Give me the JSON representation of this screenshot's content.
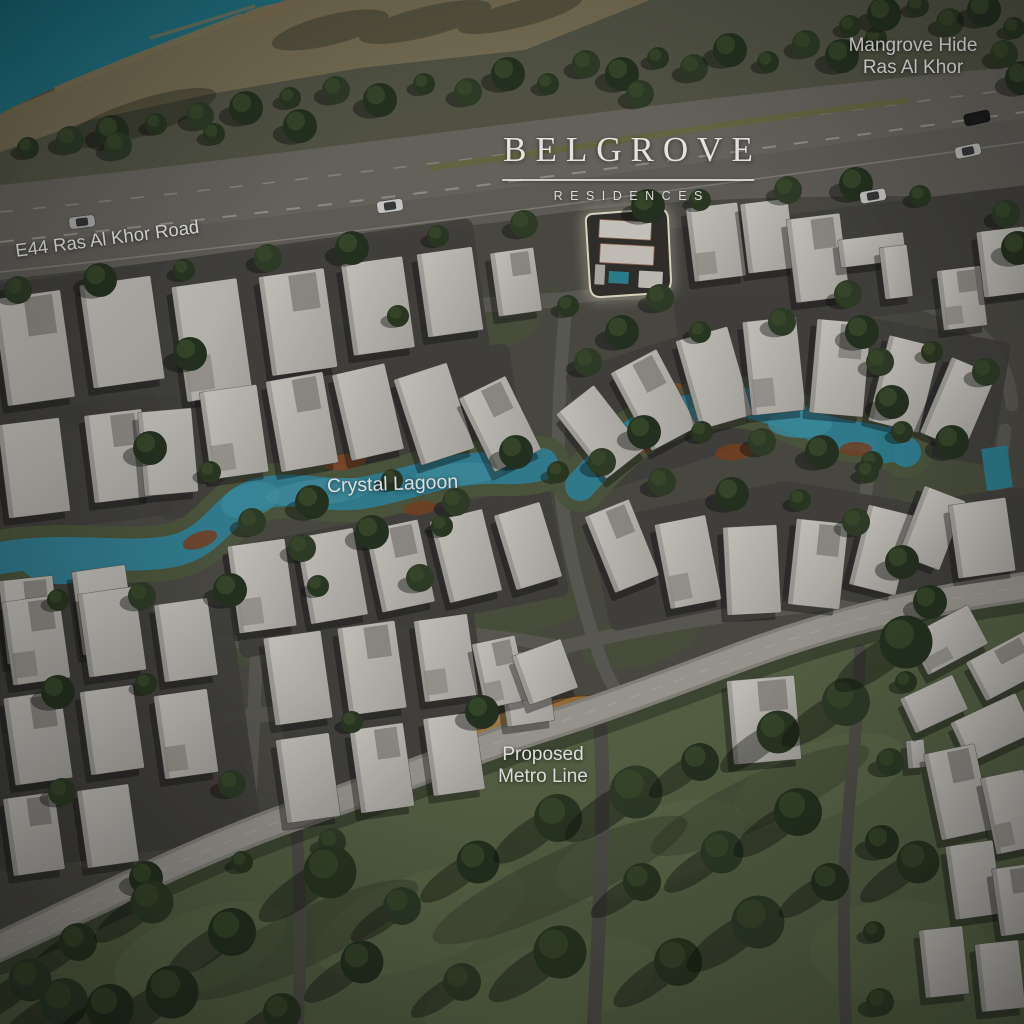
{
  "brand": {
    "name": "BELGROVE",
    "subtitle": "RESIDENCES"
  },
  "labels": {
    "location": {
      "line1": "Mangrove Hide",
      "line2": "Ras Al Khor"
    },
    "highway": "E44 Ras Al Khor Road",
    "lagoon": "Crystal Lagoon",
    "metro": {
      "line1": "Proposed",
      "line2": "Metro Line"
    }
  },
  "colors": {
    "khor_water": "#1d7584",
    "lagoon_water": "#35869a",
    "highway_asphalt": "#6e6b64",
    "street_asphalt": "#615f58",
    "building_roof": "#ccc9c3",
    "grass_field": "#5b6849",
    "tree_canopy": "#2c3a24",
    "beach_sand": "#857a5e",
    "lagoon_beach_rust": "#7d4526",
    "metro_station_gold": "#b98a50",
    "highlight_outline": "#efe7d0",
    "label_text": "#f4f4f2"
  }
}
